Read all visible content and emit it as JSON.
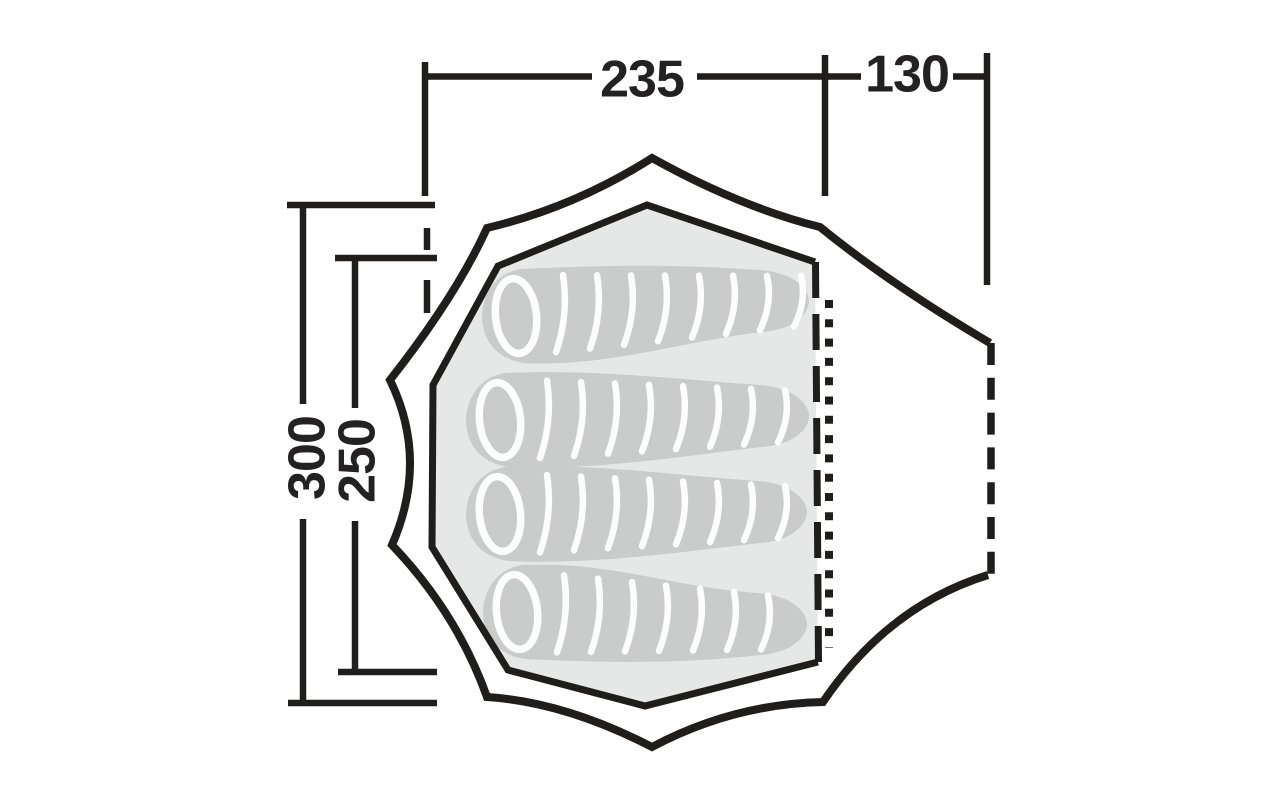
{
  "diagram": {
    "type": "tent-floorplan-top-view",
    "dimensions": {
      "inner_width": {
        "label": "235",
        "orientation": "horizontal"
      },
      "porch_width": {
        "label": "130",
        "orientation": "horizontal"
      },
      "outer_length": {
        "label": "300",
        "orientation": "vertical"
      },
      "inner_length": {
        "label": "250",
        "orientation": "vertical"
      }
    },
    "sleeping_bags": {
      "count": 4
    },
    "markings": {
      "entrance_zipper": "dotted-line",
      "inner_door_edge": "dashed-line",
      "porch_edge": "dashed-line"
    },
    "colors": {
      "line": "#1f1e1c",
      "dimension_text": "#242122",
      "floor": "#e6e8e7",
      "sleeping_bag": "#c9cccb",
      "stripe": "#fdfdfd",
      "background": "#ffffff"
    }
  }
}
